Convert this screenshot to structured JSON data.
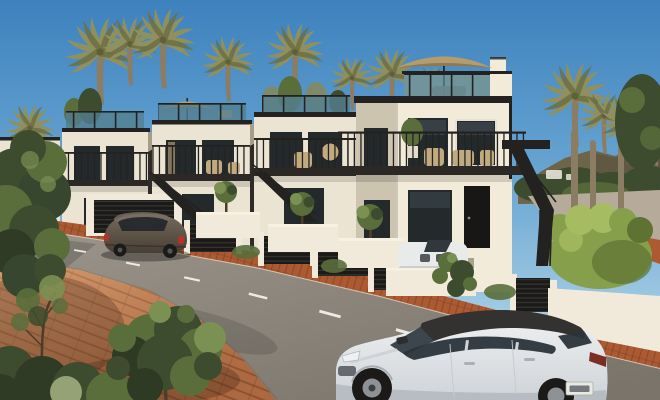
{
  "scene": {
    "description": "Architectural render of a row of modern white townhouses with black railings and exterior staircases, rooftop terraces with tan parasols, palm trees, green hills, a hedge and ramp at right, terracotta brick sidewalks, a gray street with dashed lane markings, a dark parked car at left and a white SUV with black roof driving at bottom right",
    "objects": [
      "sky",
      "hills",
      "palm-trees",
      "townhouses",
      "roof-terraces",
      "parasols",
      "balconies",
      "exterior-stairs",
      "garden-walls",
      "garage-grilles",
      "olive-trees",
      "hedge",
      "ramp",
      "road",
      "lane-markings",
      "terracotta-sidewalk",
      "parked-car",
      "white-suv",
      "driveway-car",
      "foreground-trees"
    ],
    "counts": {
      "townhouse_units": 5,
      "palm_trees": 13,
      "cars": 3,
      "parasols": 2,
      "lane_dashes": 9
    }
  },
  "colors": {
    "sky_top": "#3d81bd",
    "sky_mid": "#6aa6d3",
    "sky_horizon": "#a9cfe5",
    "sky_low": "#cfe3ee",
    "hills": "#6d6449",
    "hills_shadow": "#59503f",
    "palm_frond": "#90905e",
    "palm_frond_dark": "#6d7044",
    "palm_trunk": "#8b7c64",
    "facade_lit": "#ece4d3",
    "facade_warm": "#f3ebd9",
    "facade_shadow": "#cdc4b0",
    "recess": "#a69c88",
    "white_wall": "#f1eadb",
    "trim_dark": "#242220",
    "glass_rail": "#53808f",
    "window_glass": "#24292c",
    "window_reflect": "#48585f",
    "balcony_slab": "#2b2825",
    "umbrella": "#b49c6e",
    "umbrella_shade": "#8f7951",
    "furniture_tan": "#c2aa7f",
    "road_far": "#9b958b",
    "road_near": "#7a746a",
    "lane_dash": "#eceae3",
    "curb": "#d8d0c0",
    "pav_fg": "#c07c52",
    "pav_strip": "#ad5a33",
    "grout": "#6e3a20",
    "ramp": "#b6ab9b",
    "hedge": "#869f4b",
    "hedge_light": "#a6bc62",
    "hedge_shadow": "#5d7233",
    "green_dark": "#3d4c2e",
    "green_mid": "#5a6e3c",
    "green_light": "#7b9053",
    "sage": "#94a276",
    "trunk_brown": "#4d3c29",
    "car_body_hl": "#766a5c",
    "car_body": "#483f35",
    "car_window": "#22262c",
    "tail_red": "#b23428",
    "suv_body_hl": "#f0f2f4",
    "suv_body": "#ced3d7",
    "suv_roof": "#343230",
    "suv_glass": "#2b343b",
    "plate": "#e9e9e4",
    "wheel": "#1b1a18",
    "rim": "#8e9296",
    "distant_white": "#e8e4d9"
  }
}
